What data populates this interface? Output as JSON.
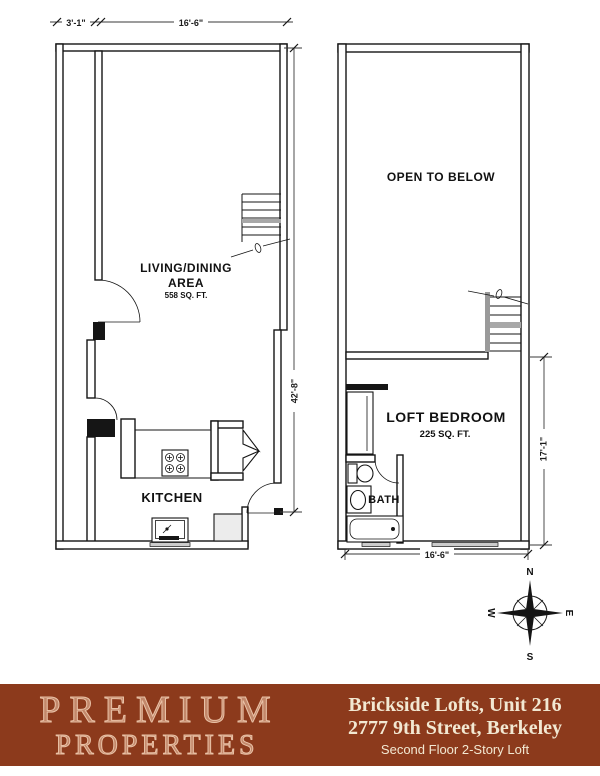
{
  "first_floor": {
    "living_line1": "LIVING/DINING",
    "living_line2": "AREA",
    "living_sqft": "558 SQ. FT.",
    "kitchen_label": "KITCHEN",
    "dim_top_left": "3'-1\"",
    "dim_top_main": "16'-6\"",
    "dim_right": "42'-8\""
  },
  "second_floor": {
    "open_label": "OPEN TO BELOW",
    "bedroom_label": "LOFT BEDROOM",
    "bedroom_sqft": "225 SQ. FT.",
    "bath_label": "BATH",
    "dim_right": "17'-1\"",
    "dim_bottom": "16'-6\""
  },
  "compass": {
    "north": "N",
    "south": "S",
    "east": "E",
    "west": "W"
  },
  "footer": {
    "brand_line1": "PREMIUM",
    "brand_line2": "PROPERTIES",
    "building": "Brickside Lofts, Unit 216",
    "address": "2777 9th Street, Berkeley",
    "floor_note": "Second Floor 2-Story Loft"
  },
  "colors": {
    "footer_bg": "#8c3a1c",
    "footer_text": "#f2e8d2",
    "brand_text": "#e9c1a6",
    "plan_line": "#151515"
  }
}
